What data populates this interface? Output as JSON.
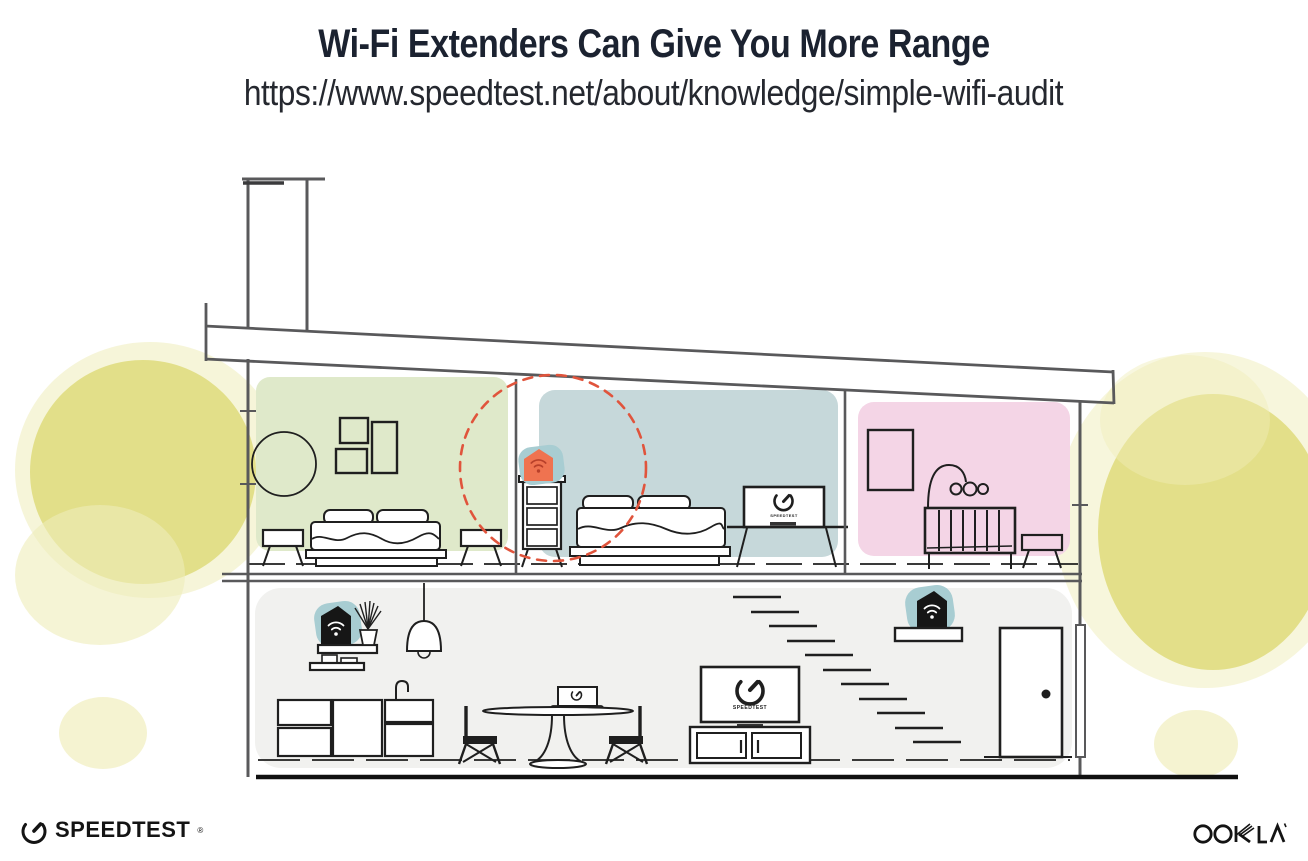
{
  "header": {
    "title": "Wi-Fi Extenders Can Give You More Range",
    "url": "https://www.speedtest.net/about/knowledge/simple-wifi-audit"
  },
  "footer": {
    "speedtest_wordmark": "SPEEDTEST",
    "speedtest_reg": "®",
    "ookla_wordmark": "OOKLA"
  },
  "illustration": {
    "tv_label": "SPEEDTEST",
    "extender_count": 3,
    "coverage_marker": "dashed-circle",
    "rooms": [
      "bedroom-green",
      "bedroom-blue",
      "nursery-pink",
      "main-floor"
    ]
  },
  "colors": {
    "title_text": "#1b2230",
    "url_text": "#25282f",
    "wall_line": "#59595b",
    "furniture_line": "#1f1f1f",
    "room_green": "#dfe9ca",
    "room_blue": "#c6d8da",
    "room_pink": "#f4d5e6",
    "device_teal": "#a8cdd2",
    "device_orange": "#ef7350",
    "device_dark": "#161616",
    "wifi_red": "#b8402a",
    "coverage_red": "#e0543c",
    "foliage": "#e0dd80",
    "foliage_light": "#efedb9",
    "floor_gray": "#f1f1ef",
    "ground_line": "#101010"
  }
}
